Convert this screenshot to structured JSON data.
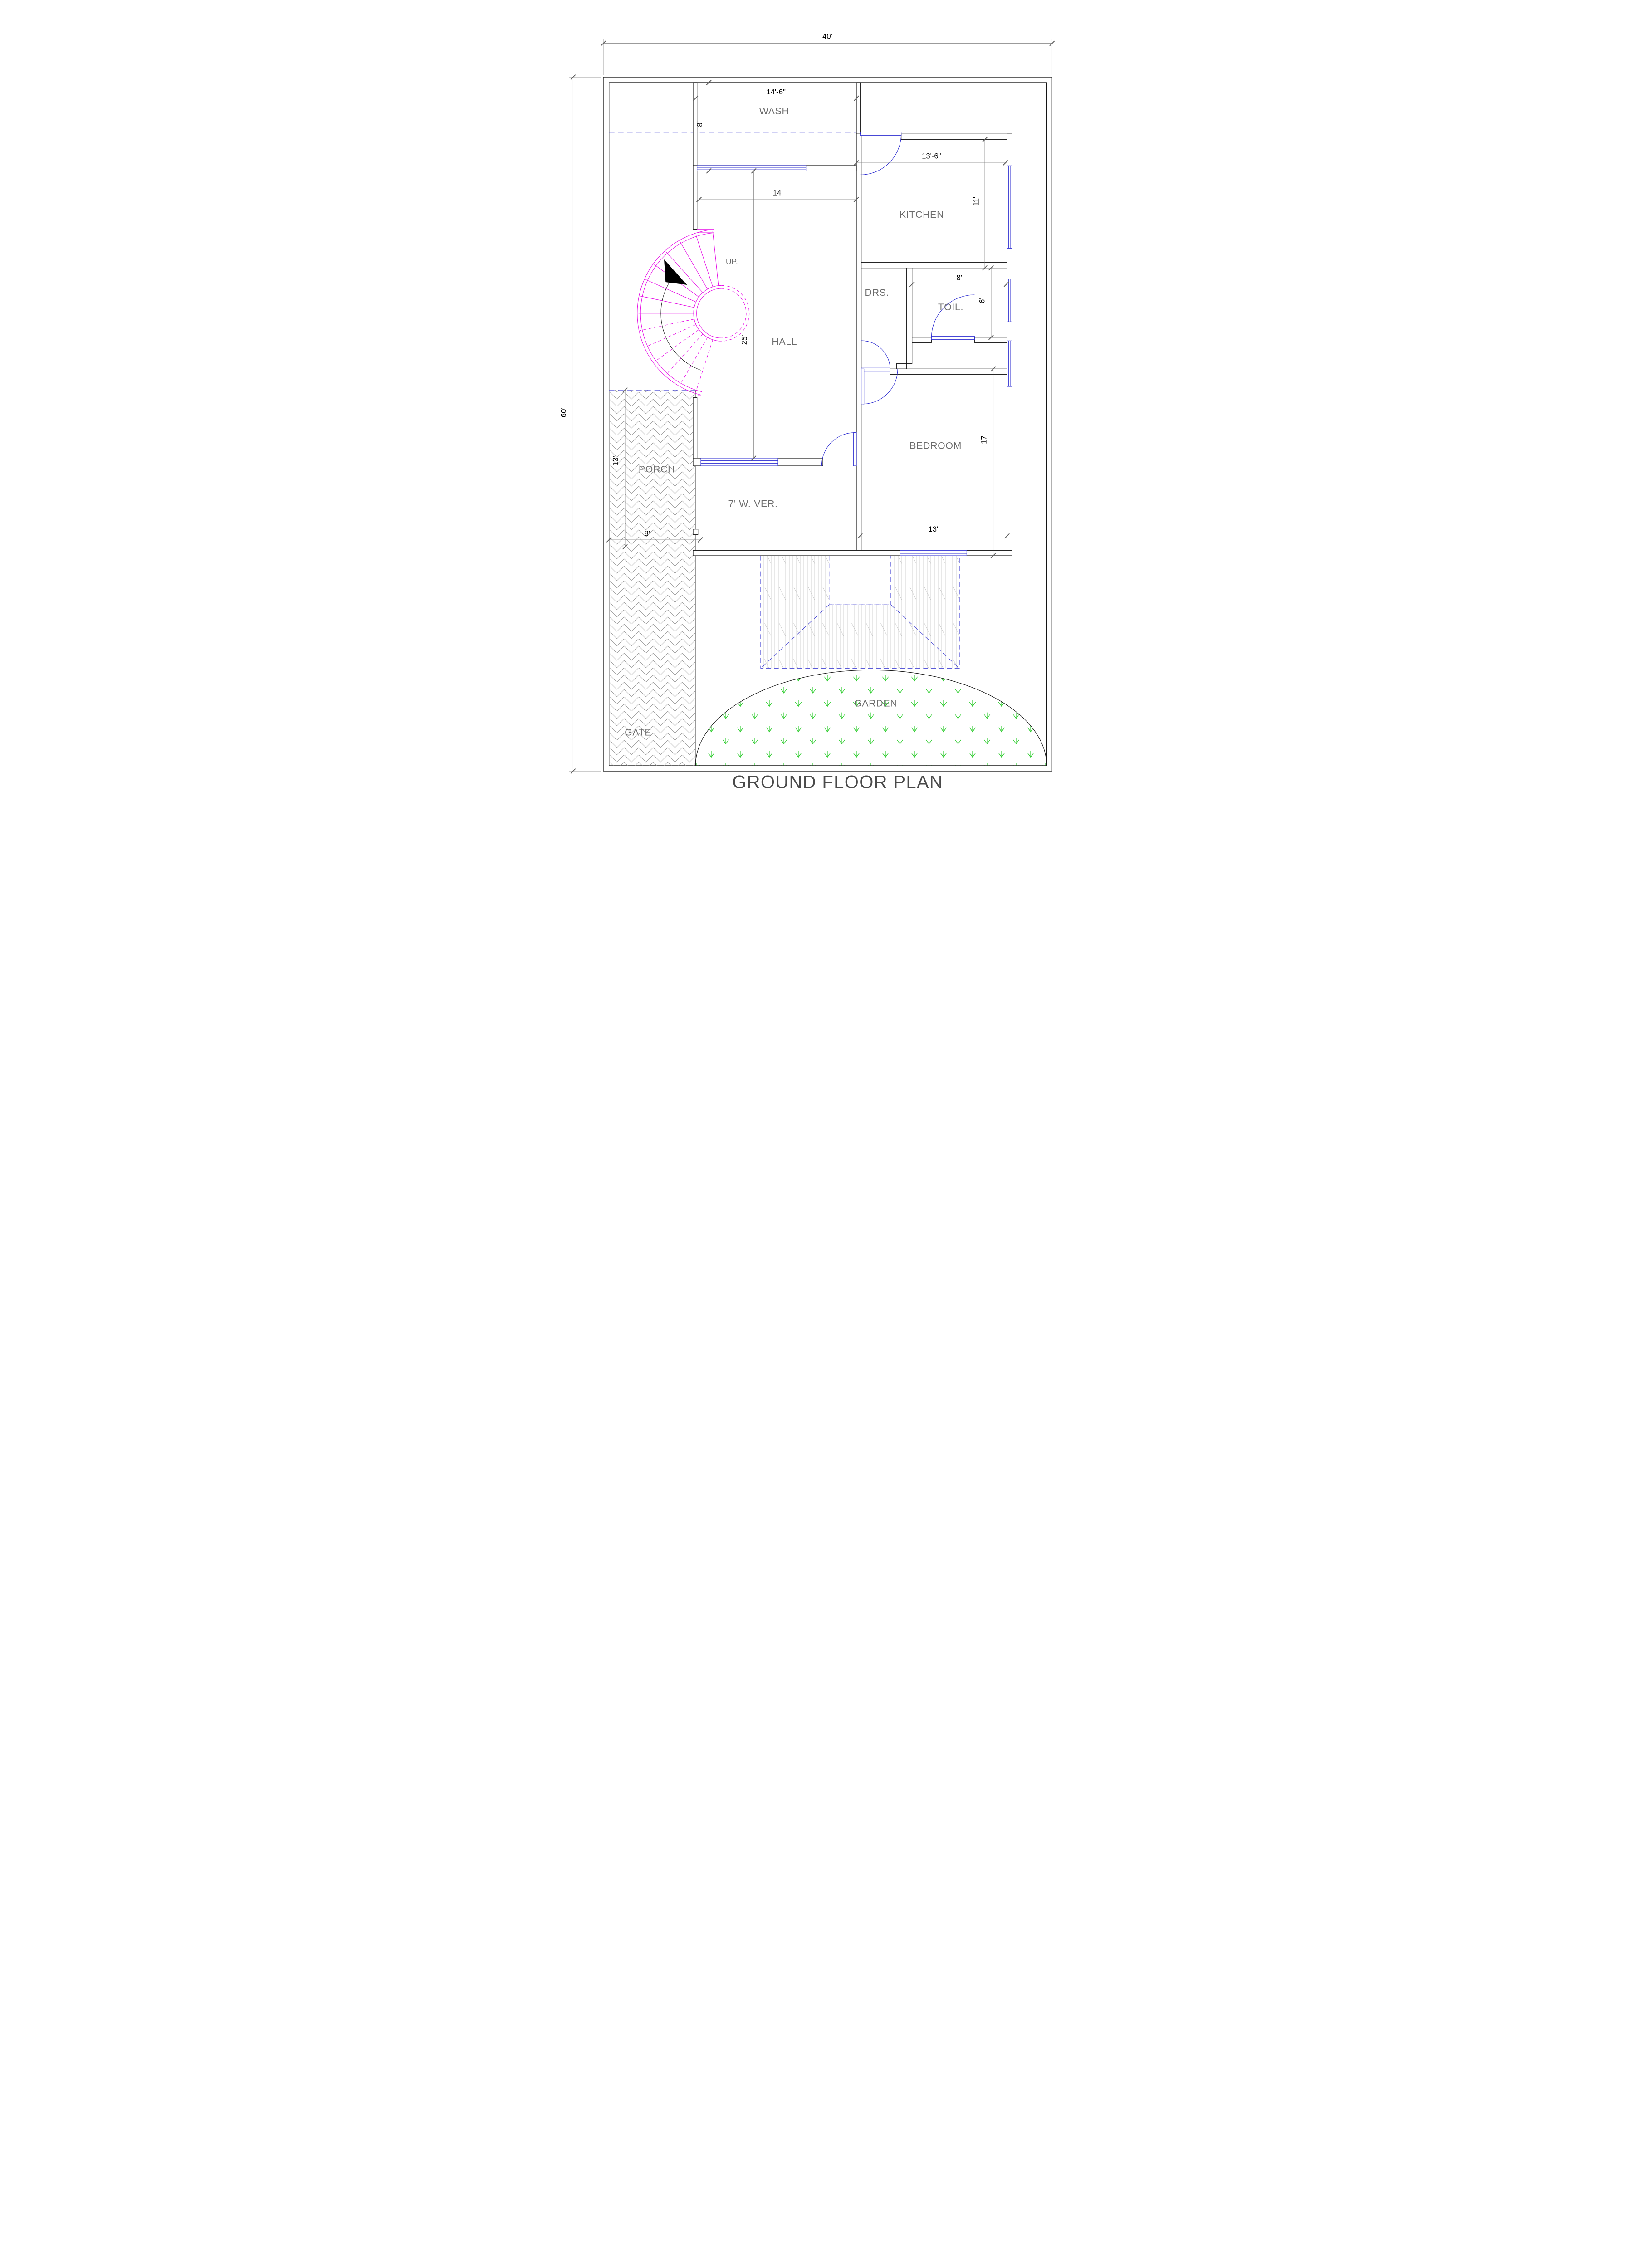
{
  "title": "GROUND FLOOR PLAN",
  "plot": {
    "width_label": "40'",
    "height_label": "60'"
  },
  "rooms": {
    "wash": {
      "label": "WASH",
      "width": "14'-6\"",
      "depth": "8'"
    },
    "kitchen": {
      "label": "KITCHEN",
      "width": "13'-6\"",
      "depth": "11'"
    },
    "hall": {
      "label": "HALL",
      "width": "14'",
      "depth": "25'"
    },
    "drs": {
      "label": "DRS."
    },
    "toilet": {
      "label": "TOIL.",
      "width": "8'",
      "depth": "6'"
    },
    "bedroom": {
      "label": "BEDROOM",
      "width": "13'",
      "depth": "17'"
    },
    "porch": {
      "label": "PORCH",
      "width": "8'",
      "depth": "13'"
    },
    "veranda": {
      "label": "7' W. VER."
    },
    "garden": {
      "label": "GARDEN"
    },
    "gate": {
      "label": "GATE"
    },
    "stair": {
      "label": "UP."
    }
  },
  "colors": {
    "walls": "#141414",
    "dim_lines": "#7a7a7a",
    "doors_windows_blue": "#2b2bd0",
    "projection_dash_blue": "#4444d4",
    "stair_magenta": "#e60ae6",
    "grass_green": "#2ecc2e",
    "hatch_gray": "#a0a0a0",
    "label_gray": "#6b6b6b"
  }
}
